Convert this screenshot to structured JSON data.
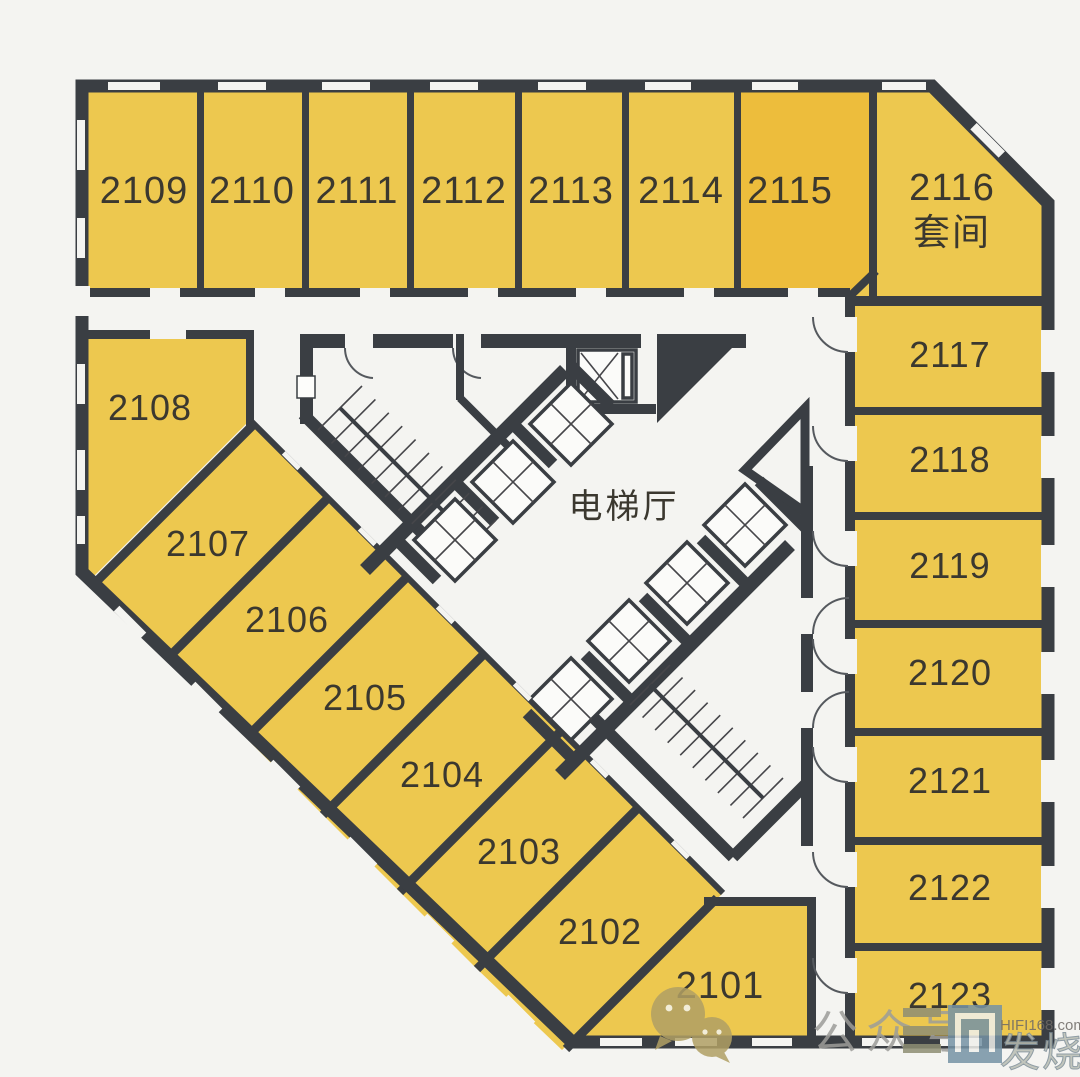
{
  "rooms": {
    "2101": "2101",
    "2102": "2102",
    "2103": "2103",
    "2104": "2104",
    "2105": "2105",
    "2106": "2106",
    "2107": "2107",
    "2108": "2108",
    "2109": "2109",
    "2110": "2110",
    "2111": "2111",
    "2112": "2112",
    "2113": "2113",
    "2114": "2114",
    "2115": "2115",
    "2117": "2117",
    "2118": "2118",
    "2119": "2119",
    "2120": "2120",
    "2121": "2121",
    "2122": "2122",
    "2123": "2123"
  },
  "suite": {
    "number": "2116",
    "type_label": "套间"
  },
  "core": {
    "elevator_hall_label": "电梯厅"
  },
  "watermark": {
    "wechat_label": "公众号",
    "site_domain": "HIFI168.com",
    "site_name": "发烧网"
  },
  "colors": {
    "background": "#f4f4f1",
    "wall": "#3a3e43",
    "room_fill": "#edc84f",
    "room_fill_alt": "#edbd3c",
    "label_color": "#3b382f",
    "watermark_gray": "#9d9d99",
    "logo_blue": "#7693a5",
    "wechat_olive": "#b1a065"
  }
}
